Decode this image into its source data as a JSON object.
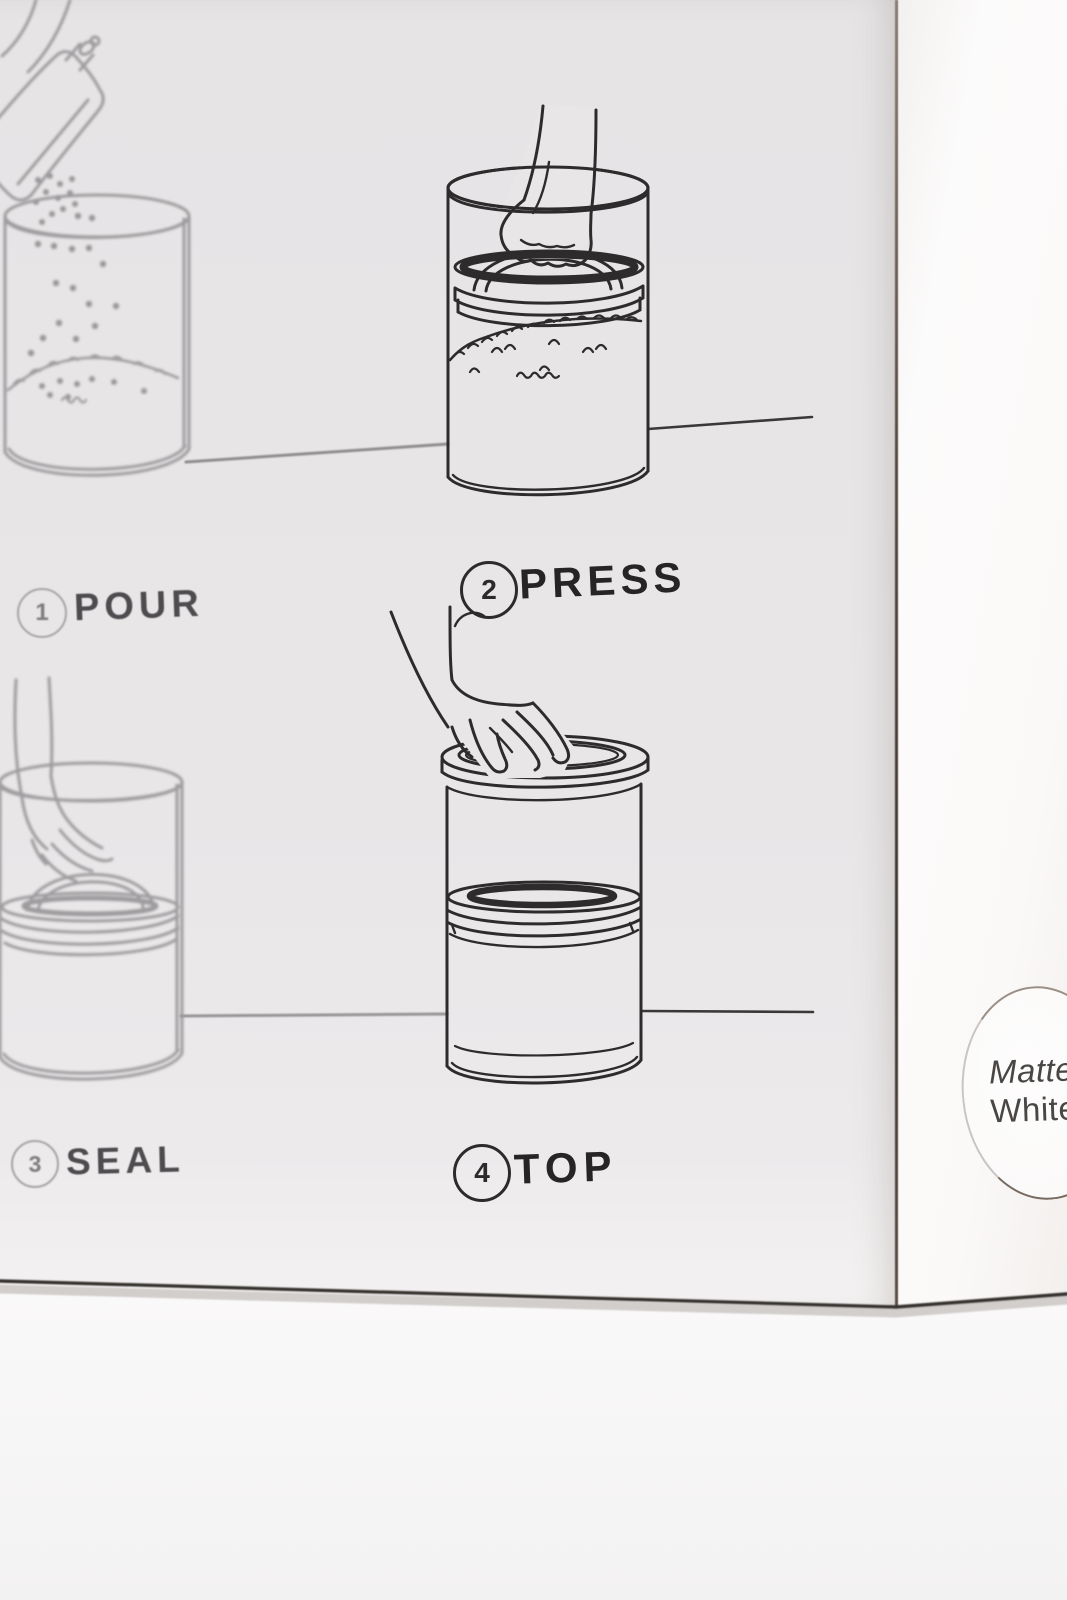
{
  "scene": {
    "description": "white product box photographed at an angle showing instruction panel",
    "finish_sticker": {
      "line1": "Matte",
      "line2": "White"
    }
  },
  "instructions": {
    "steps": [
      {
        "number": "1",
        "label": "POUR"
      },
      {
        "number": "2",
        "label": "PRESS"
      },
      {
        "number": "3",
        "label": "SEAL"
      },
      {
        "number": "4",
        "label": "TOP"
      }
    ]
  },
  "colors": {
    "box_front": "#e8e6e7",
    "box_side": "#fbfaf9",
    "ink_dark": "#2d2b2c",
    "ink_soft": "#9d9b9d",
    "label_text": "#262425",
    "sticker_text": "#4a4644",
    "crease_edge": "#4e4440"
  }
}
